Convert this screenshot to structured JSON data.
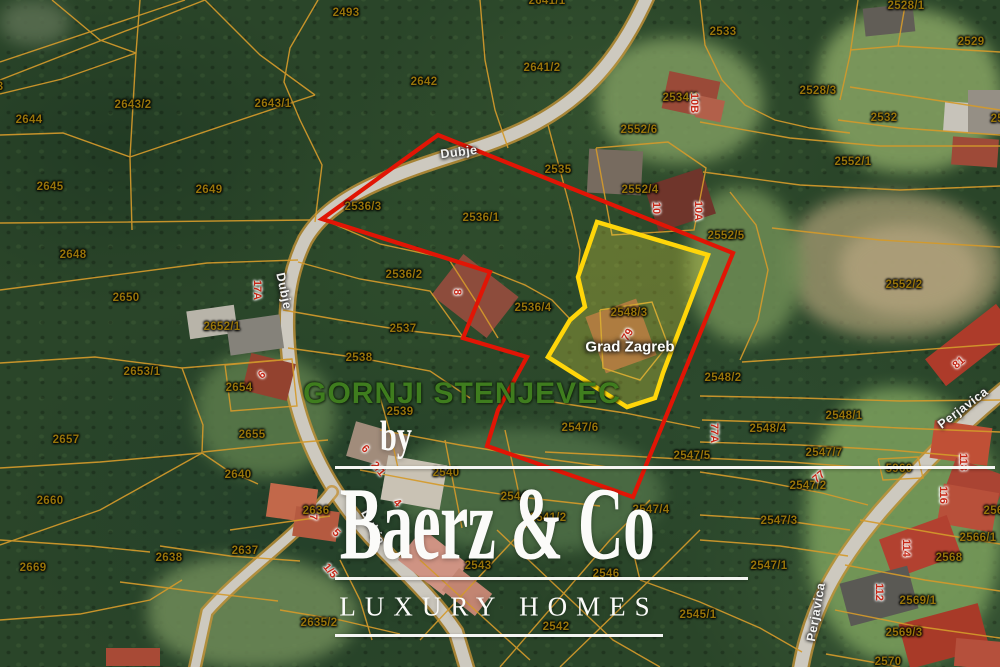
{
  "map": {
    "region_label": "GORNJI STENJEVEC",
    "municipality_label": "Grad Zagreb",
    "highlighted_parcel": "2548/3",
    "watermark": {
      "by": "by",
      "brand": "Baerz & Co",
      "tagline": "LUXURY HOMES"
    },
    "colors": {
      "red_outline": "#e11505",
      "yellow_outline": "#ffd60a",
      "parcel_line": "#d49a2b",
      "parcel_text": "#97740a",
      "house_text": "#c62817",
      "region_text": "#3f7d1e"
    },
    "overlays": {
      "red_outline_points": "438,135 733,253 633,497 487,446 498,410 527,357 463,338 490,272 322,219",
      "yellow_parcel_points": "597,222 708,255 663,373 655,398 627,407 548,357 570,320 585,307 578,277"
    },
    "road_labels": [
      {
        "t": "Dubje",
        "x": 459,
        "y": 152,
        "r": -7
      },
      {
        "t": "Dubje",
        "x": 284,
        "y": 291,
        "r": 78
      },
      {
        "t": "Dubje",
        "x": 373,
        "y": 527,
        "r": 62
      },
      {
        "t": "Perjavica",
        "x": 963,
        "y": 408,
        "r": -37
      },
      {
        "t": "Perjavica",
        "x": 816,
        "y": 612,
        "r": -80
      }
    ],
    "house_numbers": [
      {
        "t": "10B",
        "x": 694,
        "y": 103,
        "r": 90
      },
      {
        "t": "10",
        "x": 656,
        "y": 208,
        "r": 90
      },
      {
        "t": "10A",
        "x": 698,
        "y": 211,
        "r": 90
      },
      {
        "t": "17A",
        "x": 257,
        "y": 290,
        "r": 90
      },
      {
        "t": "8",
        "x": 457,
        "y": 292,
        "r": 90
      },
      {
        "t": "79",
        "x": 628,
        "y": 335,
        "r": -60
      },
      {
        "t": "81",
        "x": 959,
        "y": 363,
        "r": -40
      },
      {
        "t": "6",
        "x": 262,
        "y": 375,
        "r": -40
      },
      {
        "t": "77A",
        "x": 714,
        "y": 433,
        "r": 90
      },
      {
        "t": "6",
        "x": 365,
        "y": 449,
        "r": 45
      },
      {
        "t": "118",
        "x": 963,
        "y": 462,
        "r": 90
      },
      {
        "t": "2/1",
        "x": 378,
        "y": 469,
        "r": 50
      },
      {
        "t": "77",
        "x": 819,
        "y": 477,
        "r": -40
      },
      {
        "t": "116",
        "x": 943,
        "y": 495,
        "r": 90
      },
      {
        "t": "4",
        "x": 397,
        "y": 503,
        "r": 45
      },
      {
        "t": "7",
        "x": 313,
        "y": 517,
        "r": 90
      },
      {
        "t": "5",
        "x": 336,
        "y": 533,
        "r": 45
      },
      {
        "t": "114",
        "x": 906,
        "y": 548,
        "r": 90
      },
      {
        "t": "1/5",
        "x": 330,
        "y": 571,
        "r": 50
      },
      {
        "t": "112",
        "x": 879,
        "y": 592,
        "r": 90
      }
    ],
    "parcel_labels": [
      {
        "t": "2493",
        "x": 346,
        "y": 13
      },
      {
        "t": "2641/1",
        "x": 547,
        "y": 1
      },
      {
        "t": "2643",
        "x": -10,
        "y": 87
      },
      {
        "t": "2643/2",
        "x": 133,
        "y": 105
      },
      {
        "t": "2643/1",
        "x": 273,
        "y": 104
      },
      {
        "t": "2644",
        "x": 29,
        "y": 120
      },
      {
        "t": "2642",
        "x": 424,
        "y": 82
      },
      {
        "t": "2641/2",
        "x": 542,
        "y": 68
      },
      {
        "t": "2533",
        "x": 723,
        "y": 32
      },
      {
        "t": "2528/1",
        "x": 906,
        "y": 6
      },
      {
        "t": "2529",
        "x": 971,
        "y": 42
      },
      {
        "t": "2528/3",
        "x": 818,
        "y": 91
      },
      {
        "t": "2534/1",
        "x": 681,
        "y": 98
      },
      {
        "t": "2532",
        "x": 884,
        "y": 118
      },
      {
        "t": "2531",
        "x": 1004,
        "y": 119
      },
      {
        "t": "2645",
        "x": 50,
        "y": 187
      },
      {
        "t": "2649",
        "x": 209,
        "y": 190
      },
      {
        "t": "2552/6",
        "x": 639,
        "y": 130
      },
      {
        "t": "2552/1",
        "x": 853,
        "y": 162
      },
      {
        "t": "2535",
        "x": 558,
        "y": 170
      },
      {
        "t": "2552/4",
        "x": 640,
        "y": 190
      },
      {
        "t": "2536/3",
        "x": 363,
        "y": 207
      },
      {
        "t": "2536/1",
        "x": 481,
        "y": 218
      },
      {
        "t": "2552/5",
        "x": 726,
        "y": 236
      },
      {
        "t": "2648",
        "x": 73,
        "y": 255
      },
      {
        "t": "2536/2",
        "x": 404,
        "y": 275
      },
      {
        "t": "2552/2",
        "x": 904,
        "y": 285
      },
      {
        "t": "2650",
        "x": 126,
        "y": 298
      },
      {
        "t": "2536/4",
        "x": 533,
        "y": 308
      },
      {
        "t": "2548/3",
        "x": 629,
        "y": 313
      },
      {
        "t": "2652/1",
        "x": 222,
        "y": 327
      },
      {
        "t": "2537",
        "x": 403,
        "y": 329
      },
      {
        "t": "2538",
        "x": 359,
        "y": 358
      },
      {
        "t": "2653/1",
        "x": 142,
        "y": 372
      },
      {
        "t": "2548/2",
        "x": 723,
        "y": 378
      },
      {
        "t": "2654",
        "x": 239,
        "y": 388
      },
      {
        "t": "2539",
        "x": 400,
        "y": 412
      },
      {
        "t": "2548/1",
        "x": 844,
        "y": 416
      },
      {
        "t": "2547/6",
        "x": 580,
        "y": 428
      },
      {
        "t": "2548/4",
        "x": 768,
        "y": 429
      },
      {
        "t": "2655",
        "x": 252,
        "y": 435
      },
      {
        "t": "2657",
        "x": 66,
        "y": 440
      },
      {
        "t": "2547/7",
        "x": 824,
        "y": 453
      },
      {
        "t": "2547/5",
        "x": 692,
        "y": 456
      },
      {
        "t": "5960",
        "x": 899,
        "y": 469
      },
      {
        "t": "2540",
        "x": 446,
        "y": 473
      },
      {
        "t": "2640",
        "x": 238,
        "y": 475
      },
      {
        "t": "2547/2",
        "x": 808,
        "y": 486
      },
      {
        "t": "2544",
        "x": 514,
        "y": 497
      },
      {
        "t": "2660",
        "x": 50,
        "y": 501
      },
      {
        "t": "2547/4",
        "x": 651,
        "y": 510
      },
      {
        "t": "2636",
        "x": 316,
        "y": 511
      },
      {
        "t": "2565/1",
        "x": 1002,
        "y": 511
      },
      {
        "t": "2541/2",
        "x": 548,
        "y": 518
      },
      {
        "t": "2547/3",
        "x": 779,
        "y": 521
      },
      {
        "t": "2566/1",
        "x": 978,
        "y": 538
      },
      {
        "t": "2637",
        "x": 245,
        "y": 551
      },
      {
        "t": "2638",
        "x": 169,
        "y": 558
      },
      {
        "t": "2568",
        "x": 949,
        "y": 558
      },
      {
        "t": "2543",
        "x": 478,
        "y": 566
      },
      {
        "t": "2547/1",
        "x": 769,
        "y": 566
      },
      {
        "t": "2669",
        "x": 33,
        "y": 568
      },
      {
        "t": "2546",
        "x": 606,
        "y": 574
      },
      {
        "t": "2569/1",
        "x": 918,
        "y": 601
      },
      {
        "t": "2545/1",
        "x": 698,
        "y": 615
      },
      {
        "t": "2635/2",
        "x": 319,
        "y": 623
      },
      {
        "t": "2542",
        "x": 556,
        "y": 627
      },
      {
        "t": "2569/3",
        "x": 904,
        "y": 633
      },
      {
        "t": "2570",
        "x": 888,
        "y": 662
      }
    ]
  }
}
